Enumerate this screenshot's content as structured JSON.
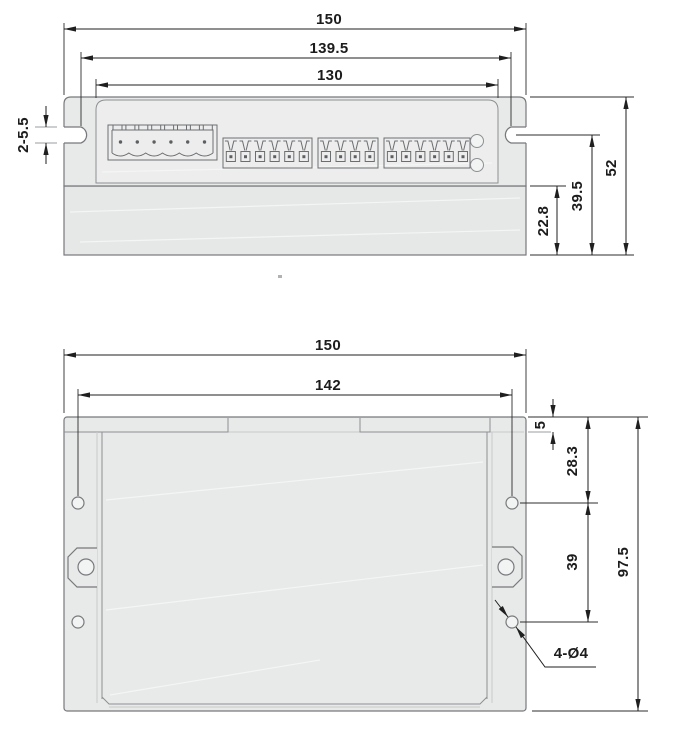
{
  "front_view": {
    "dims": {
      "overall_width": "150",
      "slot_center_width": "139.5",
      "panel_width": "130",
      "slot_callout": "2-5.5",
      "overall_height": "52",
      "slot_center_height": "39.5",
      "base_height": "22.8"
    }
  },
  "plan_view": {
    "dims": {
      "overall_width": "150",
      "hole_center_width": "142",
      "top_edge_depth": "5",
      "first_hole_offset": "28.3",
      "hole_spacing": "39",
      "overall_height": "97.5",
      "hole_callout": "4-Ø4"
    }
  },
  "colors": {
    "dimension_line": "#1f1f1f",
    "body_outline": "#77797c",
    "body_fill": "#e8e9e9",
    "panel_fill": "#ededee",
    "surface_highlight": "#f4f5f5"
  }
}
